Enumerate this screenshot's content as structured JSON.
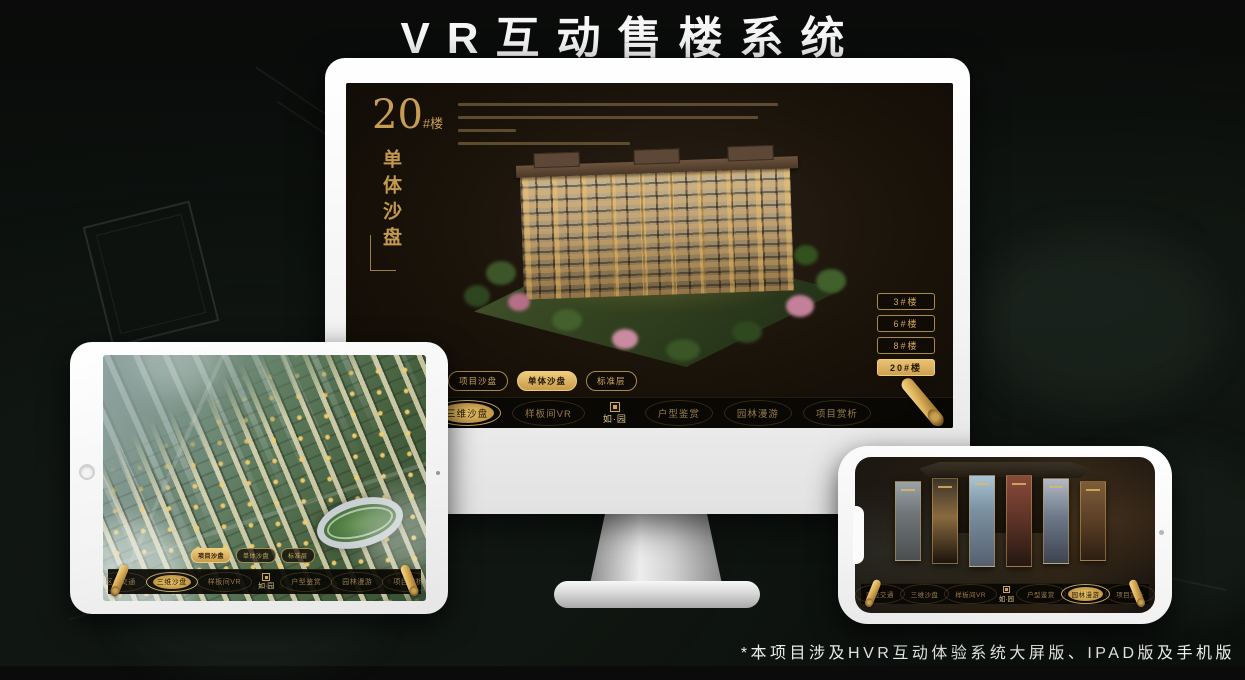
{
  "page": {
    "title": "VR互动售楼系统",
    "footnote": "*本项目涉及HVR互动体验系统大屏版、IPAD版及手机版"
  },
  "colors": {
    "gold": "#cfa85c",
    "gold_selected": "#e9c271",
    "screen_bg": "#191209",
    "nav_bg": "#0a0806",
    "title_text": "#f6f6f6"
  },
  "monitor_screen": {
    "building_label": {
      "number": "20",
      "unit": "#楼",
      "vertical_title": "单体沙盘"
    },
    "building_buttons": [
      {
        "label": "3#楼",
        "selected": false
      },
      {
        "label": "6#楼",
        "selected": false
      },
      {
        "label": "8#楼",
        "selected": false
      },
      {
        "label": "20#楼",
        "selected": true
      }
    ],
    "selected_sub_tab": "单体沙盘",
    "selected_nav": "三维沙盘"
  },
  "sub_tabs": [
    {
      "label": "项目沙盘"
    },
    {
      "label": "单体沙盘"
    },
    {
      "label": "标准层"
    }
  ],
  "nav": {
    "logo": "如·园",
    "items_left": [
      "区位交通",
      "三维沙盘",
      "样板间VR"
    ],
    "items_right": [
      "户型鉴赏",
      "园林漫游",
      "项目赏析"
    ]
  },
  "tablet_screen": {
    "selected_sub_tab": "项目沙盘",
    "selected_nav": "三维沙盘"
  },
  "phone_screen": {
    "selected_nav": "园林漫游"
  }
}
